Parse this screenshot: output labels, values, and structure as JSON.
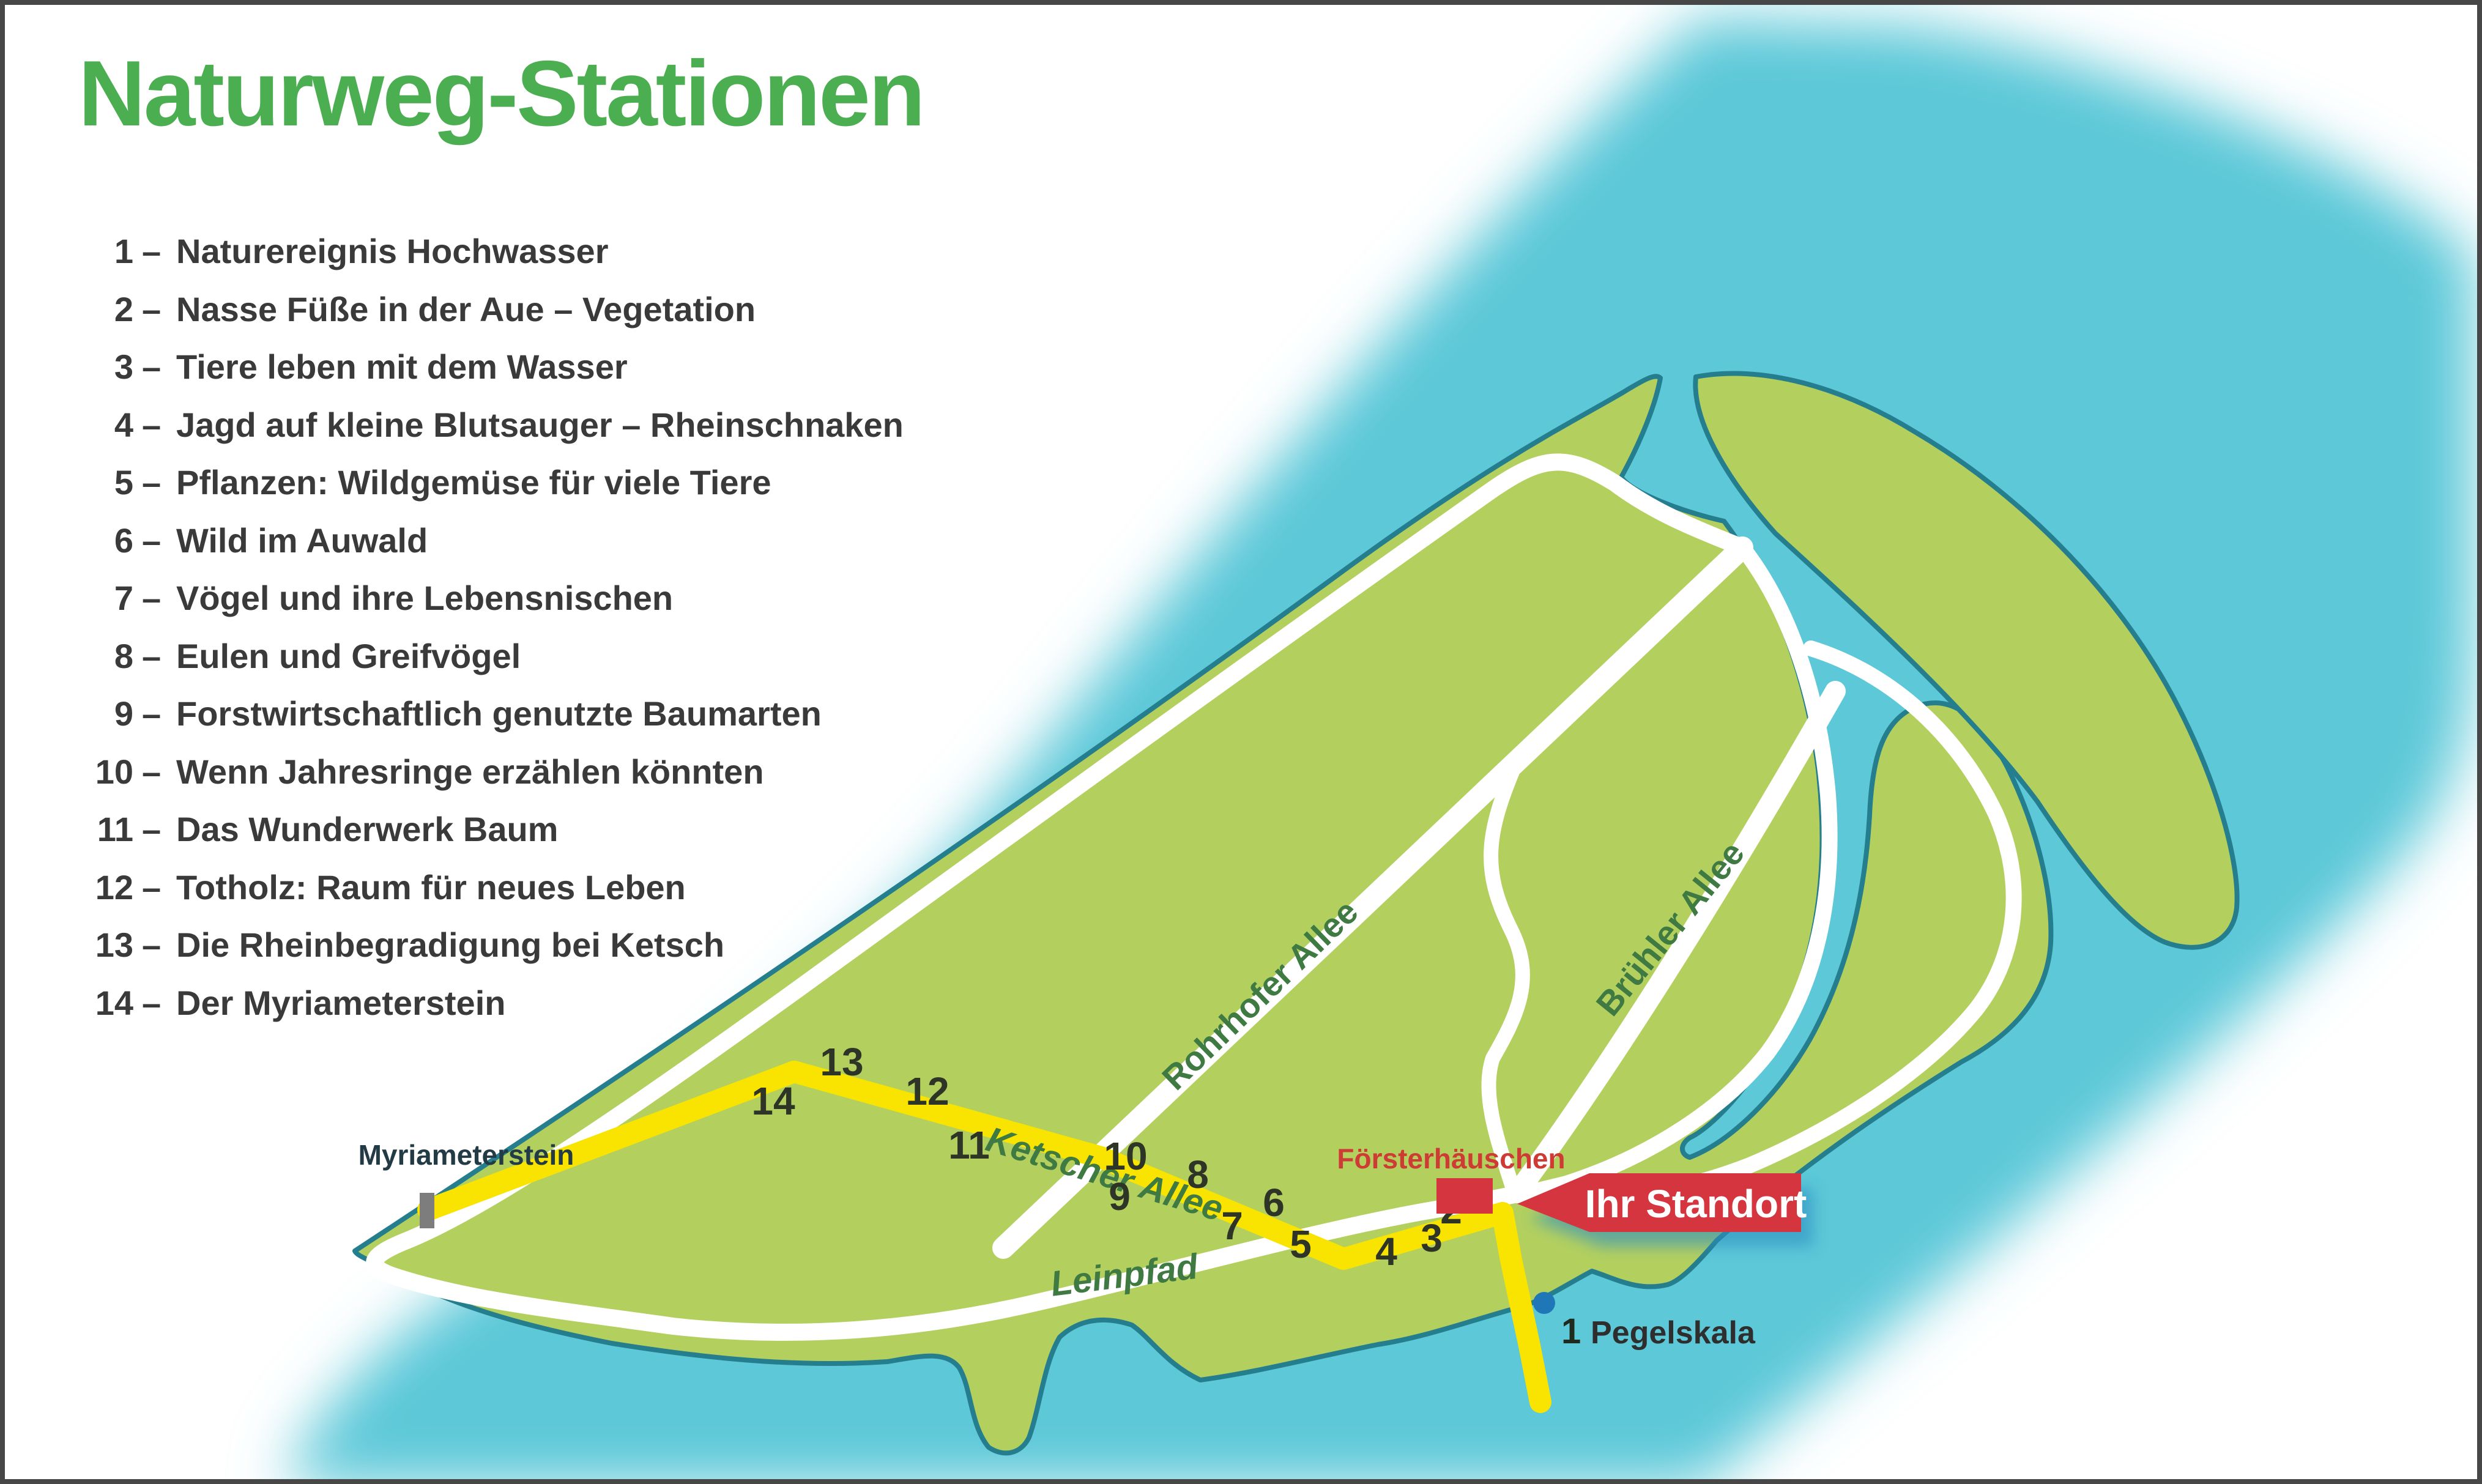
{
  "title": {
    "text": "Naturweg-Stationen",
    "color": "#4BAE50"
  },
  "legend": {
    "dash": "–",
    "text_color": "#3A3A3A",
    "items": [
      {
        "num": "1",
        "title": "Naturereignis Hochwasser"
      },
      {
        "num": "2",
        "title": "Nasse Füße in der Aue – Vegetation"
      },
      {
        "num": "3",
        "title": "Tiere leben mit dem Wasser"
      },
      {
        "num": "4",
        "title": "Jagd auf kleine Blutsauger – Rheinschnaken"
      },
      {
        "num": "5",
        "title": "Pflanzen: Wildgemüse für viele Tiere"
      },
      {
        "num": "6",
        "title": "Wild im Auwald"
      },
      {
        "num": "7",
        "title": "Vögel und ihre Lebensnischen"
      },
      {
        "num": "8",
        "title": "Eulen und Greifvögel"
      },
      {
        "num": "9",
        "title": "Forstwirtschaftlich genutzte Baumarten"
      },
      {
        "num": "10",
        "title": "Wenn Jahresringe erzählen könnten"
      },
      {
        "num": "11",
        "title": "Das Wunderwerk Baum"
      },
      {
        "num": "12",
        "title": "Totholz: Raum für neues Leben"
      },
      {
        "num": "13",
        "title": "Die Rheinbegradigung bei Ketsch"
      },
      {
        "num": "14",
        "title": "Der Myriameterstein"
      }
    ]
  },
  "map": {
    "colors": {
      "water": "#5CC8D8",
      "land": "#B3D05F",
      "outline": "#257E8E",
      "path_white": "#FFFFFF",
      "trail_yellow": "#F8E400",
      "accent_red": "#D5353F",
      "poi_red": "#CE3B35",
      "road_label_green": "#3E7A41",
      "stone_gray": "#7D7D7D",
      "dot_blue": "#1F77B8",
      "station_color": "#2E3526"
    },
    "roads": {
      "rohrhofer": "Rohrhofer Allee",
      "ketscher": "Ketscher Allee",
      "bruehler": "Brühler Allee",
      "leinpfad": "Leinpfad"
    },
    "poi": {
      "myriameterstein": "Myriameterstein",
      "foersterhaeuschen": "Försterhäuschen",
      "standort": "Ihr Standort",
      "pegelskala_num": "1",
      "pegelskala": "Pegelskala"
    },
    "stations": [
      {
        "num": "2"
      },
      {
        "num": "3"
      },
      {
        "num": "4"
      },
      {
        "num": "5"
      },
      {
        "num": "6"
      },
      {
        "num": "7"
      },
      {
        "num": "8"
      },
      {
        "num": "9"
      },
      {
        "num": "10"
      },
      {
        "num": "11"
      },
      {
        "num": "12"
      },
      {
        "num": "13"
      },
      {
        "num": "14"
      }
    ]
  }
}
